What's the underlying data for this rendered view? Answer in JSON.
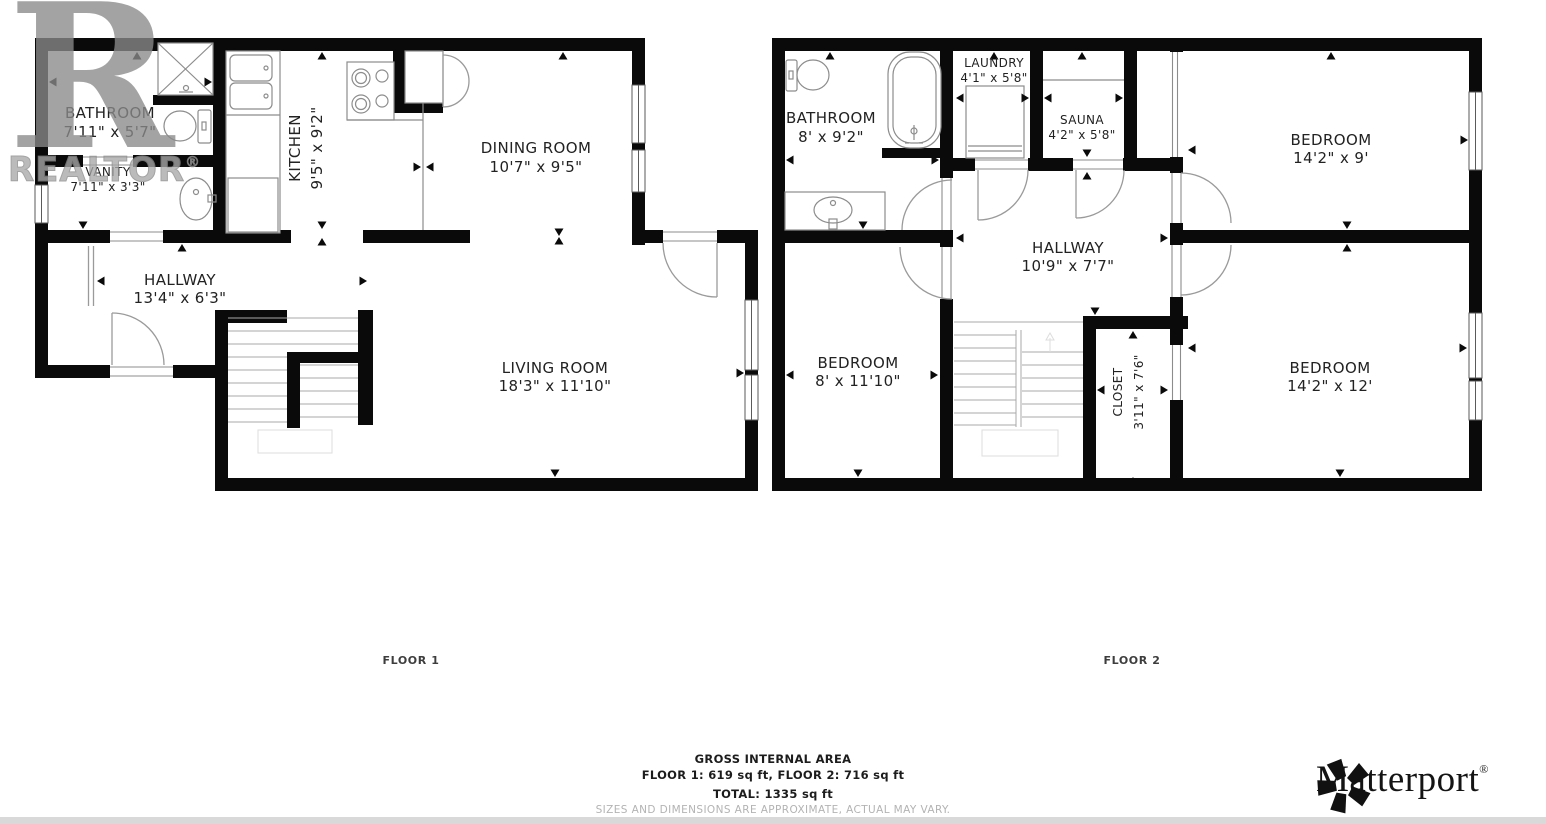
{
  "watermark": {
    "letter": "R",
    "word": "REALTOR",
    "reg": "®"
  },
  "floor1": {
    "label": "FLOOR 1",
    "bathroom": {
      "name": "BATHROOM",
      "dims": "7'11\" x 5'7\""
    },
    "vanity": {
      "name": "VANITY",
      "dims": "7'11\" x 3'3\""
    },
    "kitchen": {
      "name": "KITCHEN",
      "dims": "9'5\" x 9'2\""
    },
    "dining": {
      "name": "DINING ROOM",
      "dims": "10'7\" x 9'5\""
    },
    "hallway": {
      "name": "HALLWAY",
      "dims": "13'4\" x 6'3\""
    },
    "living": {
      "name": "LIVING ROOM",
      "dims": "18'3\" x 11'10\""
    }
  },
  "floor2": {
    "label": "FLOOR 2",
    "bathroom": {
      "name": "BATHROOM",
      "dims": "8' x 9'2\""
    },
    "laundry": {
      "name": "LAUNDRY",
      "dims": "4'1\" x 5'8\""
    },
    "sauna": {
      "name": "SAUNA",
      "dims": "4'2\" x 5'8\""
    },
    "bedroom_top": {
      "name": "BEDROOM",
      "dims": "14'2\" x 9'"
    },
    "hallway": {
      "name": "HALLWAY",
      "dims": "10'9\" x 7'7\""
    },
    "bedroom_left": {
      "name": "BEDROOM",
      "dims": "8' x 11'10\""
    },
    "closet": {
      "name": "CLOSET",
      "dims": "3'11\" x 7'6\""
    },
    "bedroom_bottom": {
      "name": "BEDROOM",
      "dims": "14'2\" x 12'"
    }
  },
  "summary": {
    "title": "GROSS INTERNAL AREA",
    "floors_line": "FLOOR 1: 619 sq ft, FLOOR 2: 716 sq ft",
    "total_line": "TOTAL: 1335 sq ft",
    "disclaimer": "SIZES AND DIMENSIONS ARE APPROXIMATE, ACTUAL MAY VARY."
  },
  "branding": {
    "name": "Matterport",
    "reg": "®"
  },
  "colors": {
    "walls": "#0a0a0a",
    "fixtures": "#8c8c8c",
    "watermark": "#8a8a8a",
    "disclaimer_text": "#b3b3b3",
    "footer_bar": "#d9d9d9"
  },
  "icons": {
    "realtor-watermark": "big gray R",
    "matterport-pinwheel": "5-petal black pinwheel",
    "door-arc": "quarter-circle swing",
    "window": "double line in wall",
    "stairs": "parallel treads",
    "shower": "crossed box",
    "toilet": "tank and bowl",
    "sink": "oval basin",
    "bathtub": "rounded tub",
    "washer": "front-load box",
    "stove": "four burners"
  }
}
